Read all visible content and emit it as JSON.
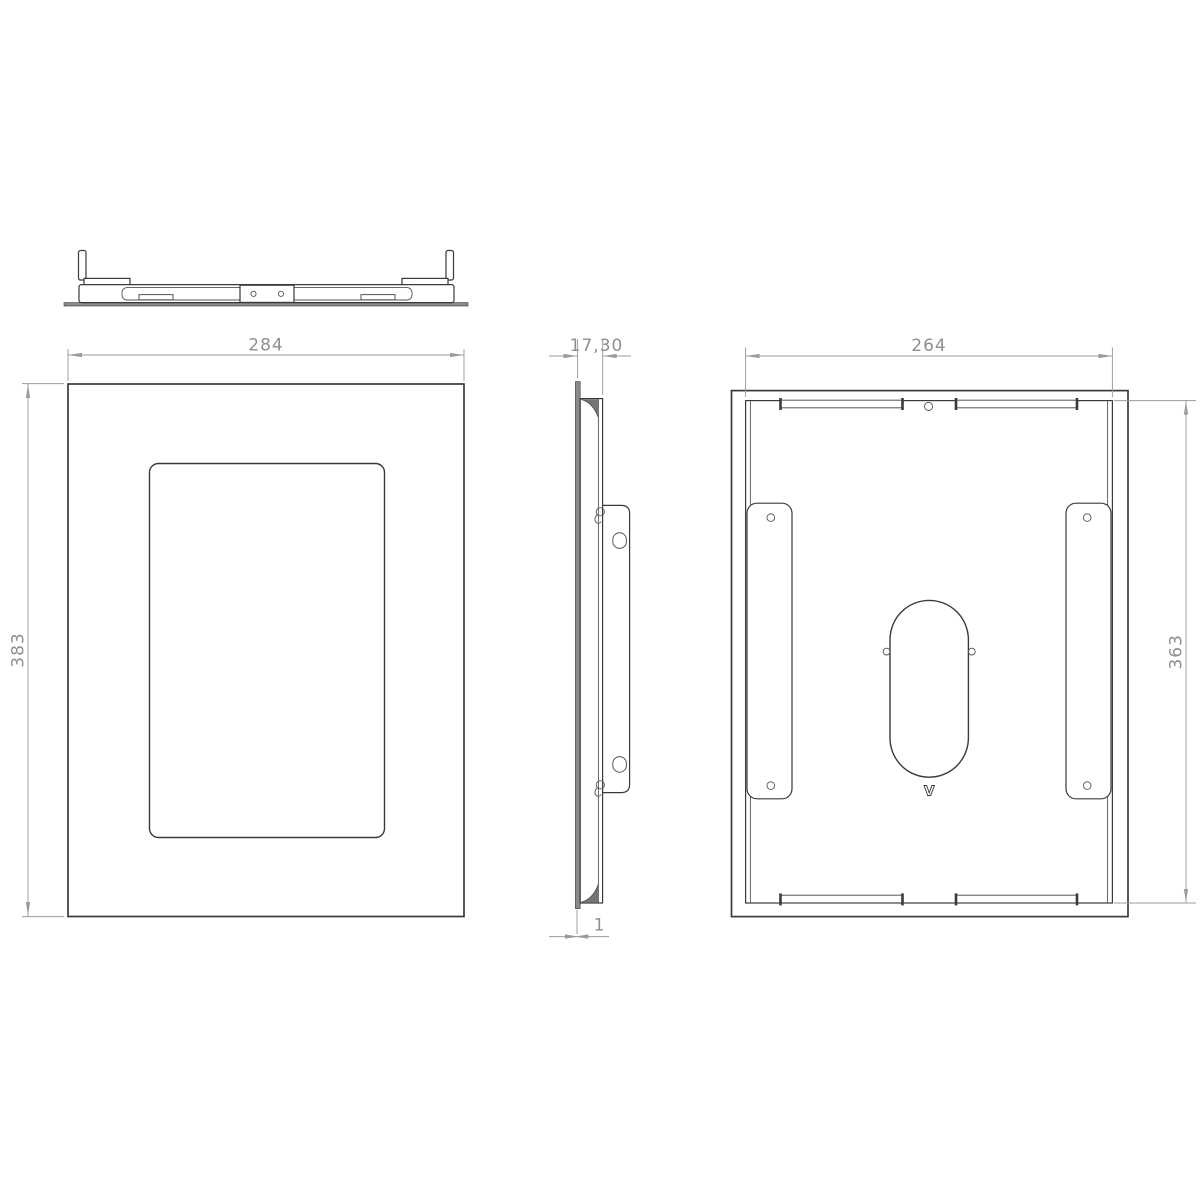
{
  "colors": {
    "background": "#ffffff",
    "line": "#3a3a3a",
    "line_thin": "#555555",
    "dim_line": "#9b9b9b",
    "dim_text": "#8f8f8f",
    "metal_fill": "#8a8a8a",
    "metal_dark": "#757575"
  },
  "dimensions": {
    "top_width": "284",
    "front_height": "383",
    "side_depth": "17,30",
    "panel_thickness": "1",
    "back_width": "264",
    "back_height": "363"
  },
  "logo": {
    "mark": "V"
  }
}
